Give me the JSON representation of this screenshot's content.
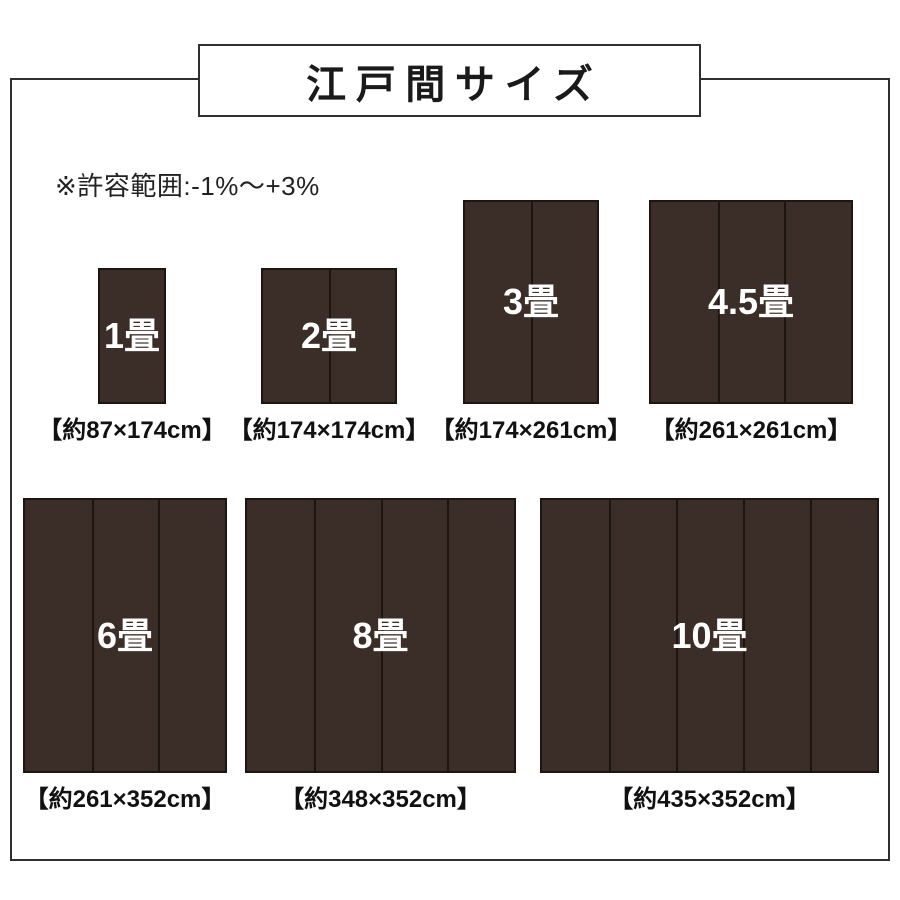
{
  "title": "江戸間サイズ",
  "note": "※許容範囲:-1%〜+3%",
  "colors": {
    "mat_brown": "#3b2d27",
    "mat_seam_line": "#1d1511",
    "frame_border": "#2f2f2f",
    "text": "#1a1a1a",
    "mat_label_text": "#ffffff"
  },
  "mats": [
    {
      "name": "1畳",
      "size_label": "【約87×174cm】",
      "width_cm": 87,
      "height_cm": 174,
      "panels": 1,
      "row": 0
    },
    {
      "name": "2畳",
      "size_label": "【約174×174cm】",
      "width_cm": 174,
      "height_cm": 174,
      "panels": 2,
      "row": 0
    },
    {
      "name": "3畳",
      "size_label": "【約174×261cm】",
      "width_cm": 174,
      "height_cm": 261,
      "panels": 2,
      "row": 0
    },
    {
      "name": "4.5畳",
      "size_label": "【約261×261cm】",
      "width_cm": 261,
      "height_cm": 261,
      "panels": 3,
      "row": 0
    },
    {
      "name": "6畳",
      "size_label": "【約261×352cm】",
      "width_cm": 261,
      "height_cm": 352,
      "panels": 3,
      "row": 1
    },
    {
      "name": "8畳",
      "size_label": "【約348×352cm】",
      "width_cm": 348,
      "height_cm": 352,
      "panels": 4,
      "row": 1
    },
    {
      "name": "10畳",
      "size_label": "【約435×352cm】",
      "width_cm": 435,
      "height_cm": 352,
      "panels": 5,
      "row": 1
    }
  ]
}
